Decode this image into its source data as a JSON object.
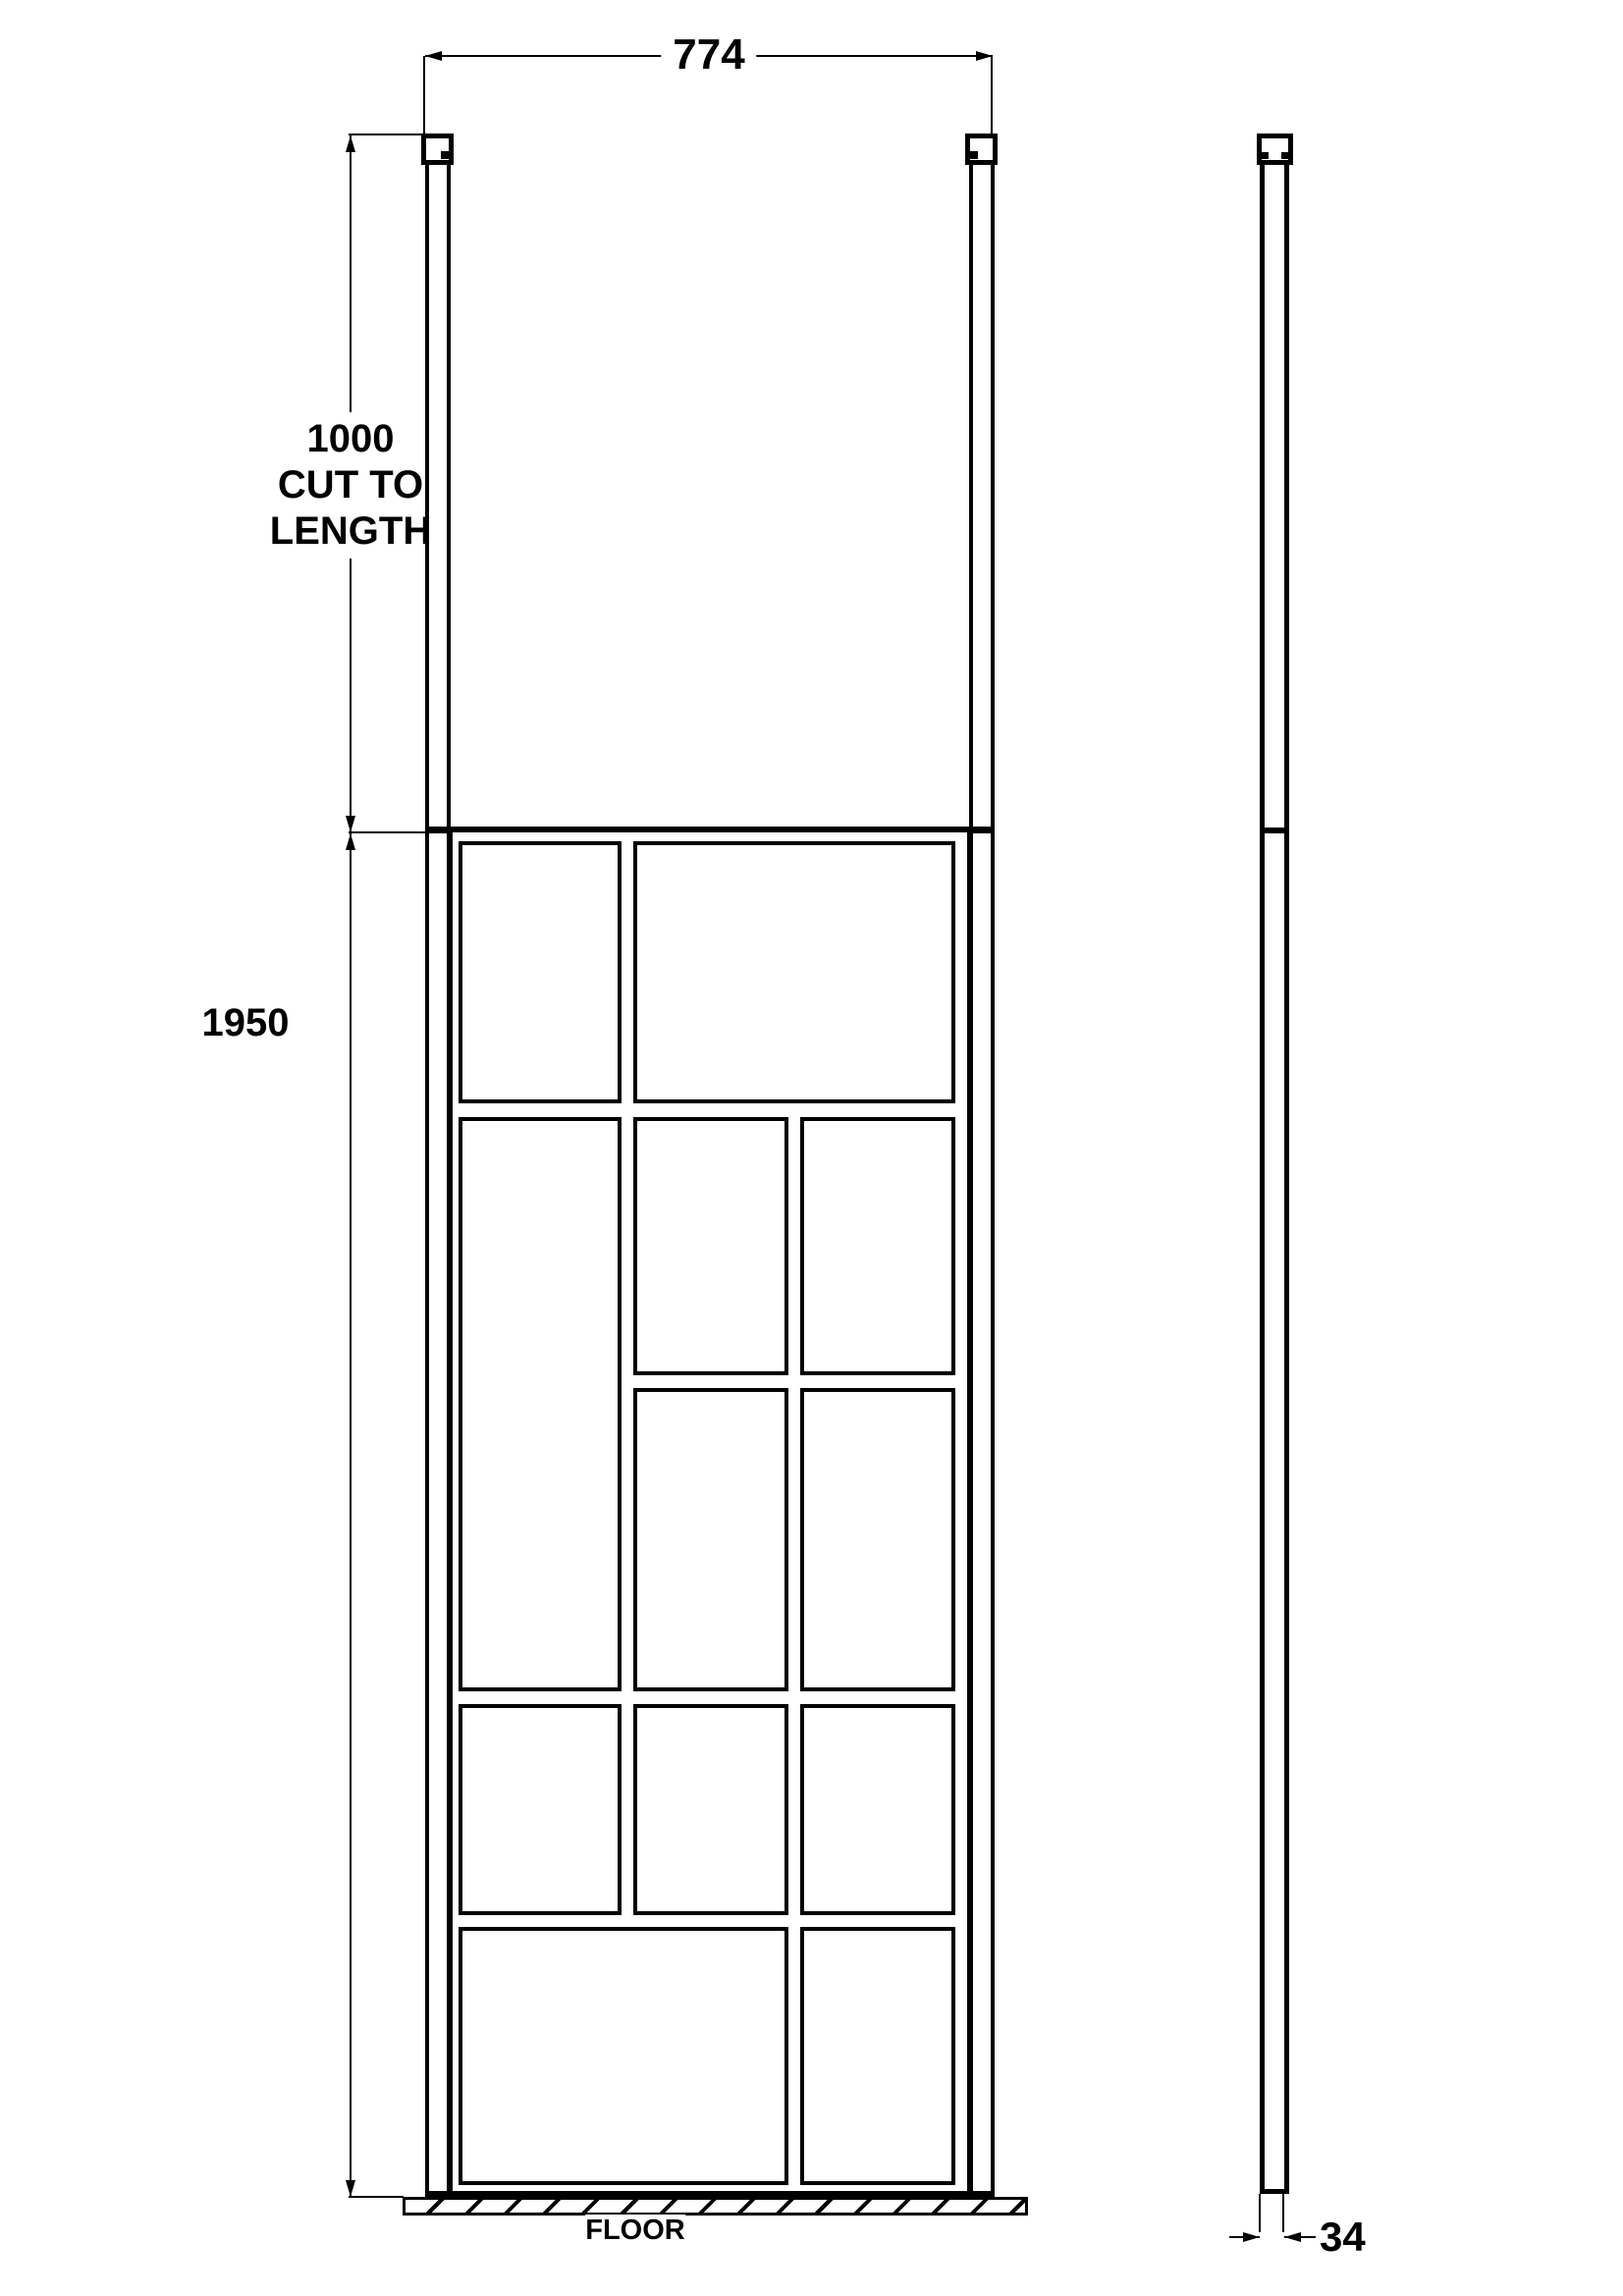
{
  "drawing": {
    "type": "shower-screen-technical-drawing",
    "views": {
      "front": "front elevation",
      "side": "side elevation"
    },
    "labels": {
      "width": "774",
      "post_l1": "1000",
      "post_l2": "CUT TO",
      "post_l3": "LENGTH",
      "height": "1950",
      "depth": "34",
      "floor": "FLOOR"
    },
    "colors": {
      "line": "#000000",
      "background": "#ffffff"
    }
  }
}
